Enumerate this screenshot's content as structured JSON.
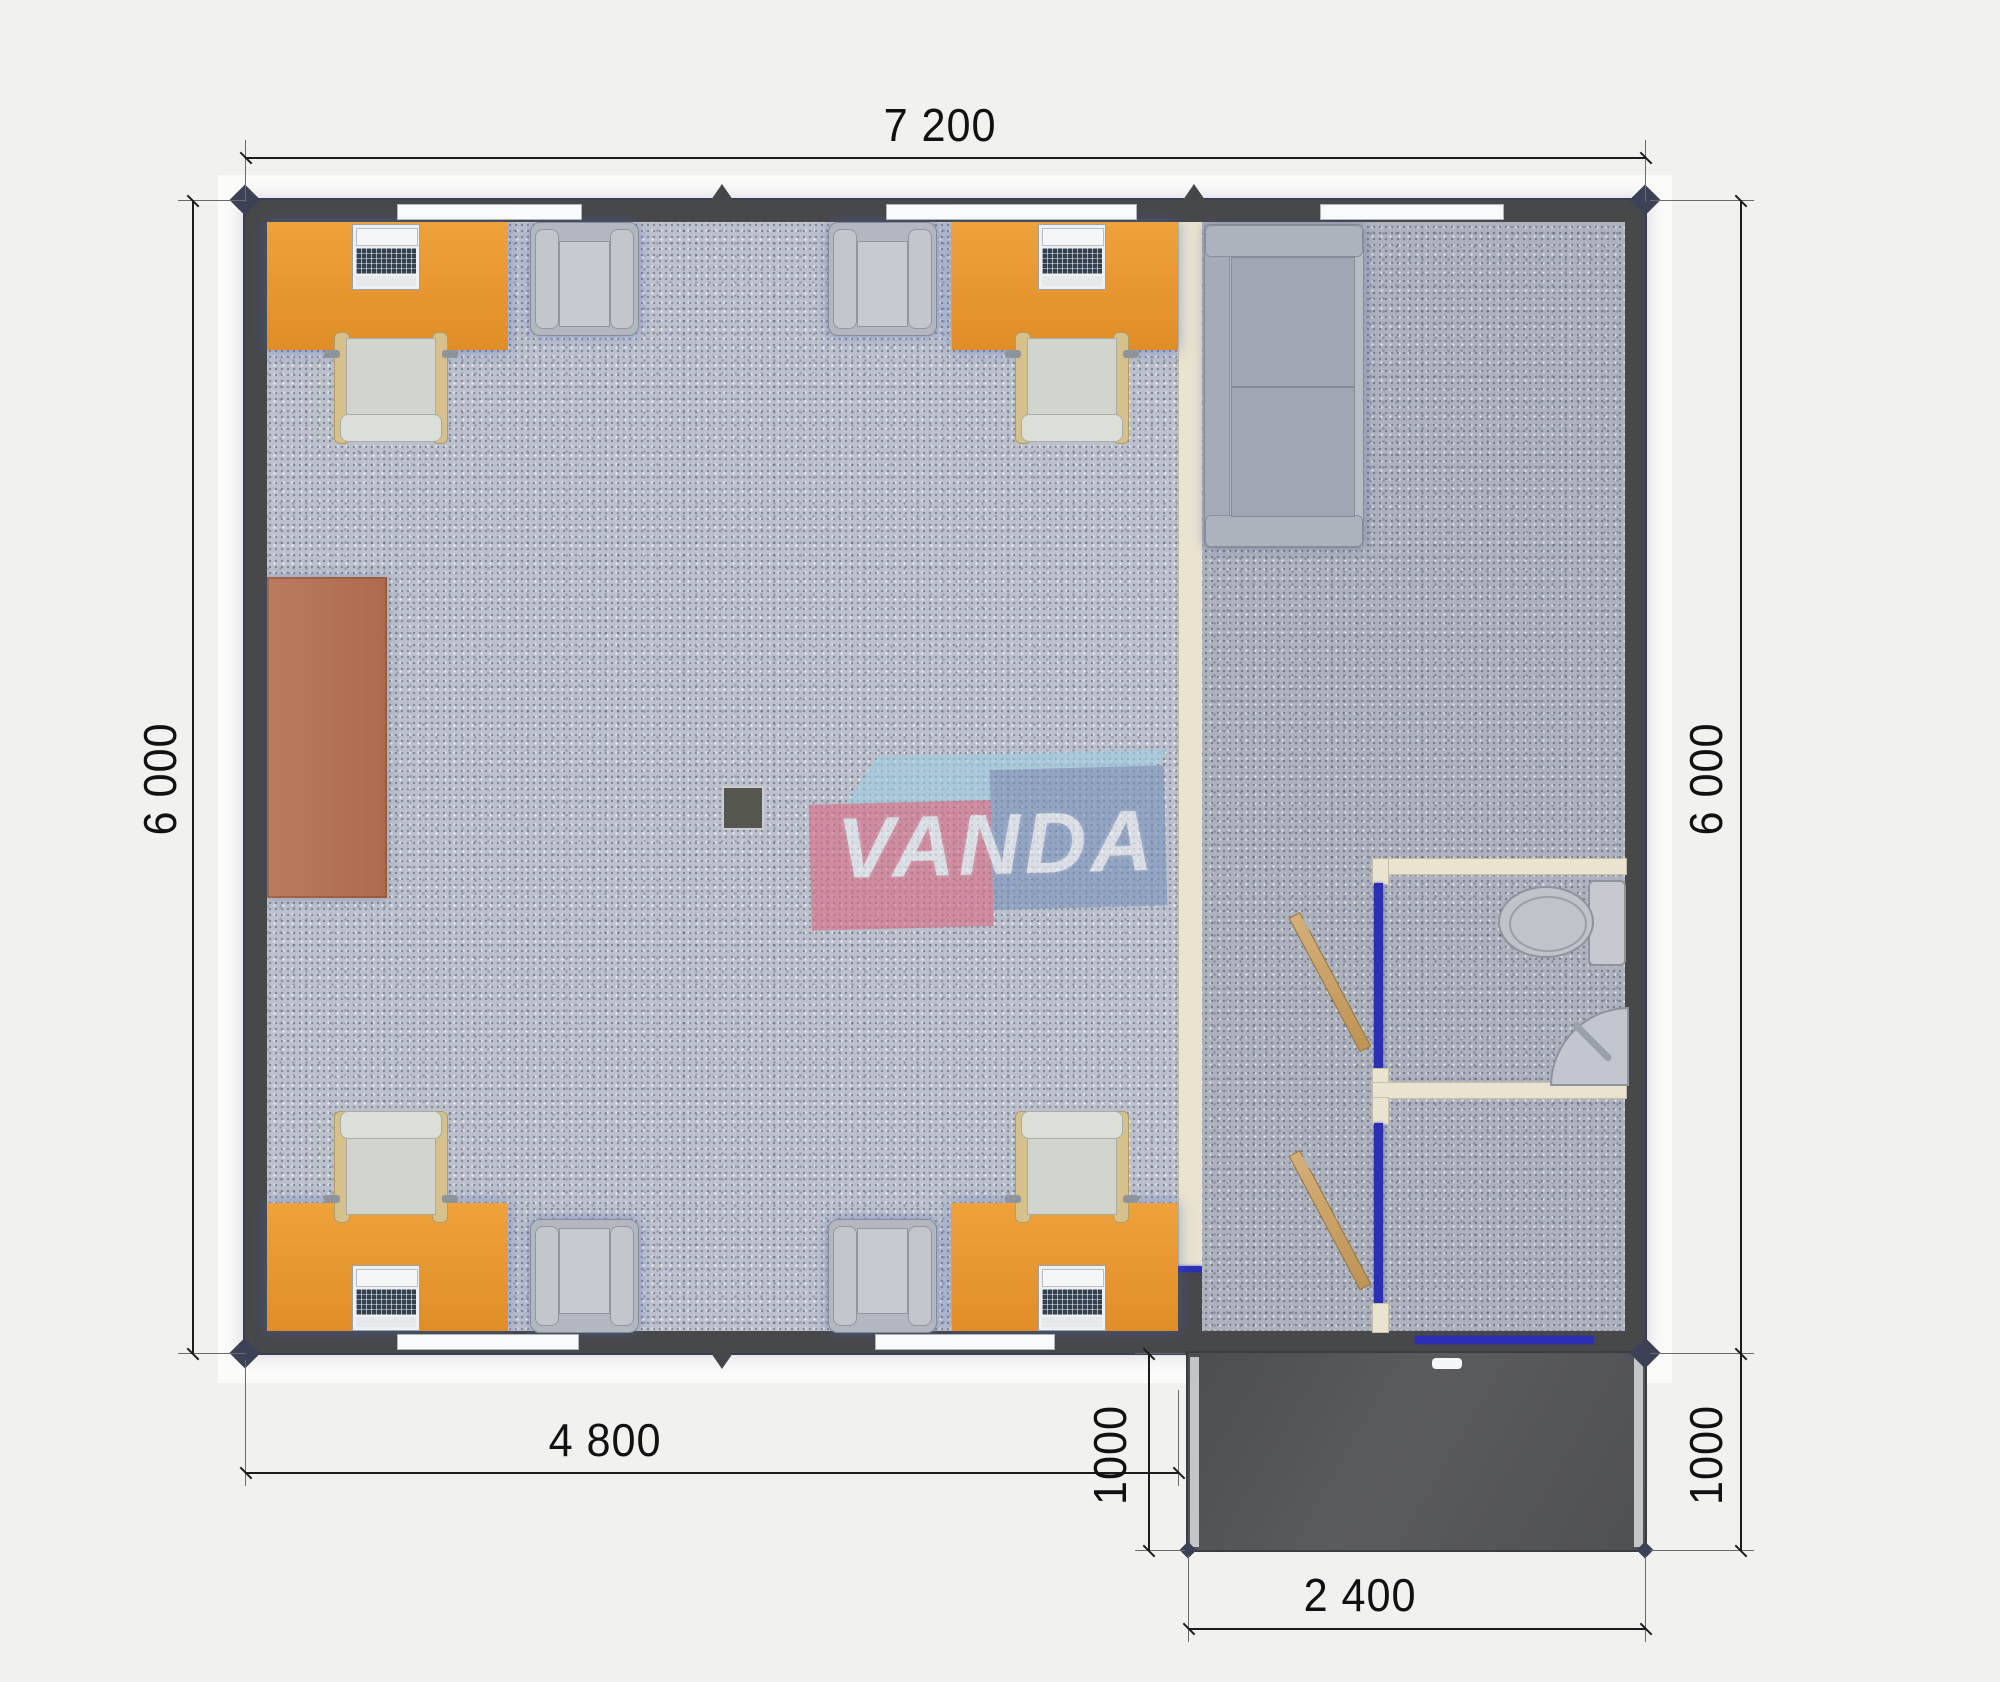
{
  "dimensions": {
    "top_width": "7 200",
    "left_height": "6 000",
    "right_height": "6 000",
    "bottom_width": "4 800",
    "porch_depth_left": "1000",
    "porch_depth_right": "1000",
    "porch_width": "2 400"
  },
  "watermark": {
    "text": "VANDA"
  },
  "colors": {
    "wall": "#47484a",
    "partition_wall": "#eae3d0",
    "carpet_left_room": "#bcc1cc",
    "carpet_right_room": "#adb2bd",
    "desk": "#e5942e",
    "cabinet": "#b5705a",
    "porch": "#535456",
    "door_wood": "#c9a26b",
    "door_frame_blue": "#2b2fb5",
    "logo_pink": "#d96d86",
    "logo_blue": "#7a93bd",
    "logo_light_blue": "#9ecfe4"
  },
  "furniture": [
    {
      "item": "office-desk-with-laptop",
      "count": 4
    },
    {
      "item": "office-chair",
      "count": 4
    },
    {
      "item": "visitor-armchair",
      "count": 4
    },
    {
      "item": "sofa",
      "count": 1
    },
    {
      "item": "sideboard-cabinet",
      "count": 1
    },
    {
      "item": "toilet",
      "count": 1
    },
    {
      "item": "corner-sink",
      "count": 1
    },
    {
      "item": "open-door",
      "count": 2
    },
    {
      "item": "floor-stove-box",
      "count": 1
    }
  ]
}
